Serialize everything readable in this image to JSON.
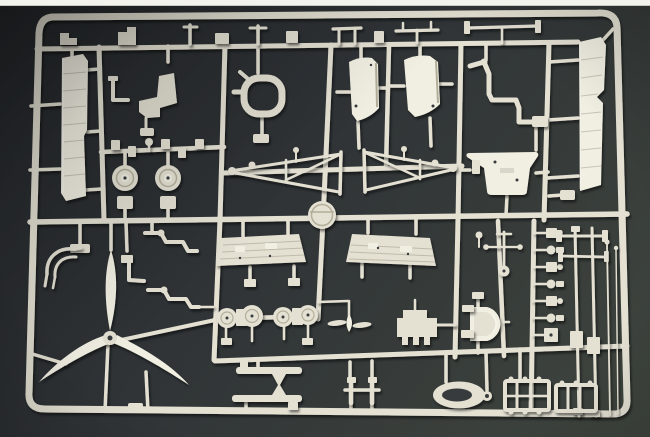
{
  "scene": {
    "description": "Photograph of a cream-colored injection-molded plastic model kit sprue (parts tree) holding aircraft model components - propeller, wheels, panels, struts, seats and small fittings - laid on a dark gray background with a white strip at the top edge of the photo."
  },
  "colors": {
    "bg-deep": "#25282b",
    "bg-mid": "#2f3336",
    "bg-light": "#3f453e",
    "plastic": "#e4e1d3",
    "plastic-light": "#f1efe2",
    "plastic-dark": "#b2ae9a",
    "hole": "#373b3d",
    "photo-strip": "#f3f3ee"
  },
  "parts": [
    {
      "name": "outer-frame"
    },
    {
      "name": "wing-panel-left"
    },
    {
      "name": "tail-panel-right"
    },
    {
      "name": "top-row-fittings"
    },
    {
      "name": "pilot-seat"
    },
    {
      "name": "exhaust-manifold"
    },
    {
      "name": "main-wheels"
    },
    {
      "name": "axle-fittings-row"
    },
    {
      "name": "cowl-panel-left"
    },
    {
      "name": "cowl-panel-right"
    },
    {
      "name": "s-curve-tube"
    },
    {
      "name": "landing-gear-truss-left"
    },
    {
      "name": "landing-gear-truss-right"
    },
    {
      "name": "cockpit-floor"
    },
    {
      "name": "sprue-gate-disc"
    },
    {
      "name": "ribbed-flap-left"
    },
    {
      "name": "ribbed-flap-right"
    },
    {
      "name": "three-blade-propeller"
    },
    {
      "name": "wishbone-bracket"
    },
    {
      "name": "zigzag-tubes"
    },
    {
      "name": "wheel-hub-discs"
    },
    {
      "name": "small-propeller"
    },
    {
      "name": "engine-bulkhead"
    },
    {
      "name": "seat-tub"
    },
    {
      "name": "control-column"
    },
    {
      "name": "wing-spar-bars"
    },
    {
      "name": "oval-pad-ring"
    },
    {
      "name": "cabane-frame"
    },
    {
      "name": "fitting-column"
    },
    {
      "name": "engine-mount-frames"
    },
    {
      "name": "strut-rods"
    },
    {
      "name": "antenna-rods"
    }
  ]
}
